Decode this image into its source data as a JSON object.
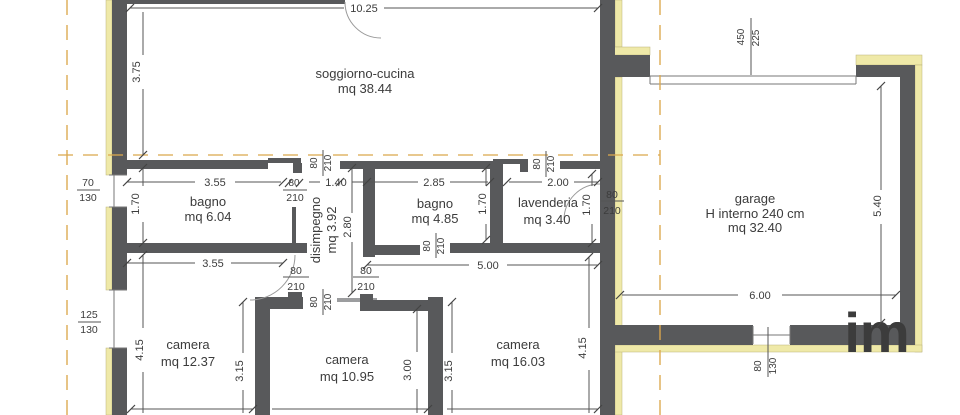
{
  "rooms": {
    "soggiorno": {
      "name": "soggiorno-cucina",
      "area": "mq 38.44"
    },
    "bagno1": {
      "name": "bagno",
      "area": "mq 6.04"
    },
    "disimpegno": {
      "name": "disimpegno",
      "area": "mq 3.92"
    },
    "bagno2": {
      "name": "bagno",
      "area": "mq 4.85"
    },
    "lavenderia": {
      "name": "lavenderia",
      "area": "mq 3.40"
    },
    "garage": {
      "name": "garage",
      "height_note": "H interno 240 cm",
      "area": "mq 32.40"
    },
    "camera1": {
      "name": "camera",
      "area": "mq 12.37"
    },
    "camera2": {
      "name": "camera",
      "area": "mq 10.95"
    },
    "camera3": {
      "name": "camera",
      "area": "mq 16.03"
    }
  },
  "dims": {
    "soggiorno_w": "10.25",
    "soggiorno_h": "3.75",
    "bagno1_w": "3.55",
    "bagno1_w2": "3.55",
    "bagno1_h": "1.70",
    "disimpegno_w": "1.40",
    "disimpegno_h": "2.80",
    "bagno2_w": "2.85",
    "bagno2_h": "1.70",
    "lavenderia_w": "2.00",
    "lavenderia_h": "1.70",
    "hall_w": "5.00",
    "camera1_h": "4.15",
    "camera3_h": "4.15",
    "camera2_side_l": "3.15",
    "camera2_w": "3.00",
    "camera2_side_r": "3.15",
    "garage_w": "6.00",
    "garage_h": "5.40"
  },
  "openings": {
    "door_w": "80",
    "door_h": "210",
    "garage_door_w": "450",
    "garage_door_h": "225",
    "win1_w": "70",
    "win1_h": "130",
    "win2_w": "125",
    "win2_h": "130",
    "garage_win_w": "80",
    "garage_win_h": "130"
  },
  "watermark": "im",
  "colors": {
    "wall": "#58595b",
    "insulation": "#efe9a8",
    "boundary": "#dca84e"
  }
}
